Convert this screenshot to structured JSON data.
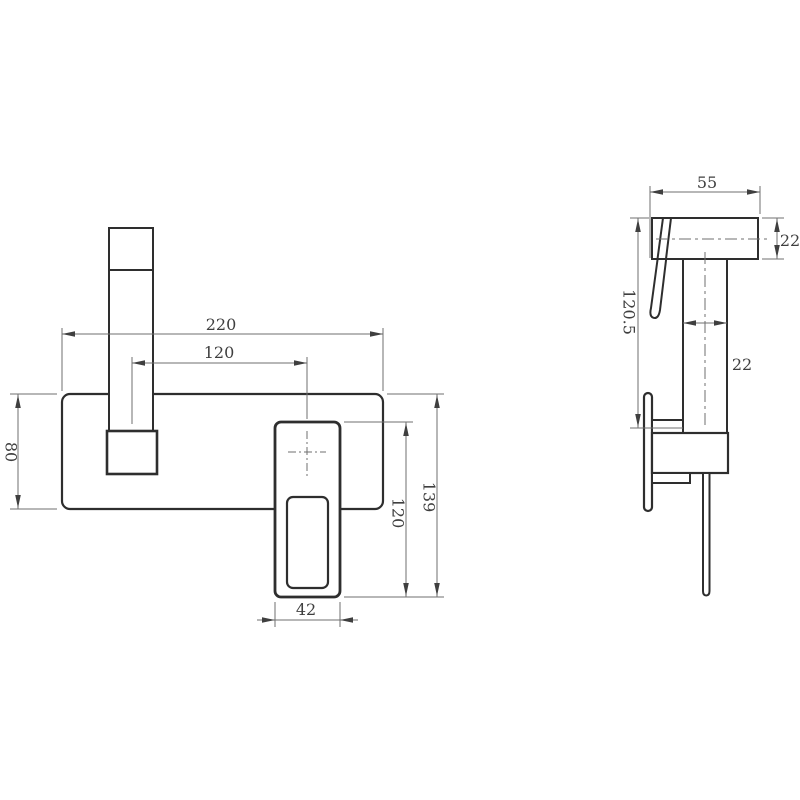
{
  "colors": {
    "paper": "#ffffff",
    "outline": "#2e2e2e",
    "dimline": "#6f6f6f",
    "dimtext": "#3f3f3f"
  },
  "front_view": {
    "dims": {
      "plate_width": "220",
      "spout_to_handle_center": "120",
      "plate_height": "80",
      "handle_length": "120",
      "overall_height": "139",
      "handle_width": "42"
    }
  },
  "side_view": {
    "dims": {
      "spout_reach": "55",
      "spout_section": "22",
      "overall_depth": "120.5",
      "body_section": "22"
    }
  }
}
